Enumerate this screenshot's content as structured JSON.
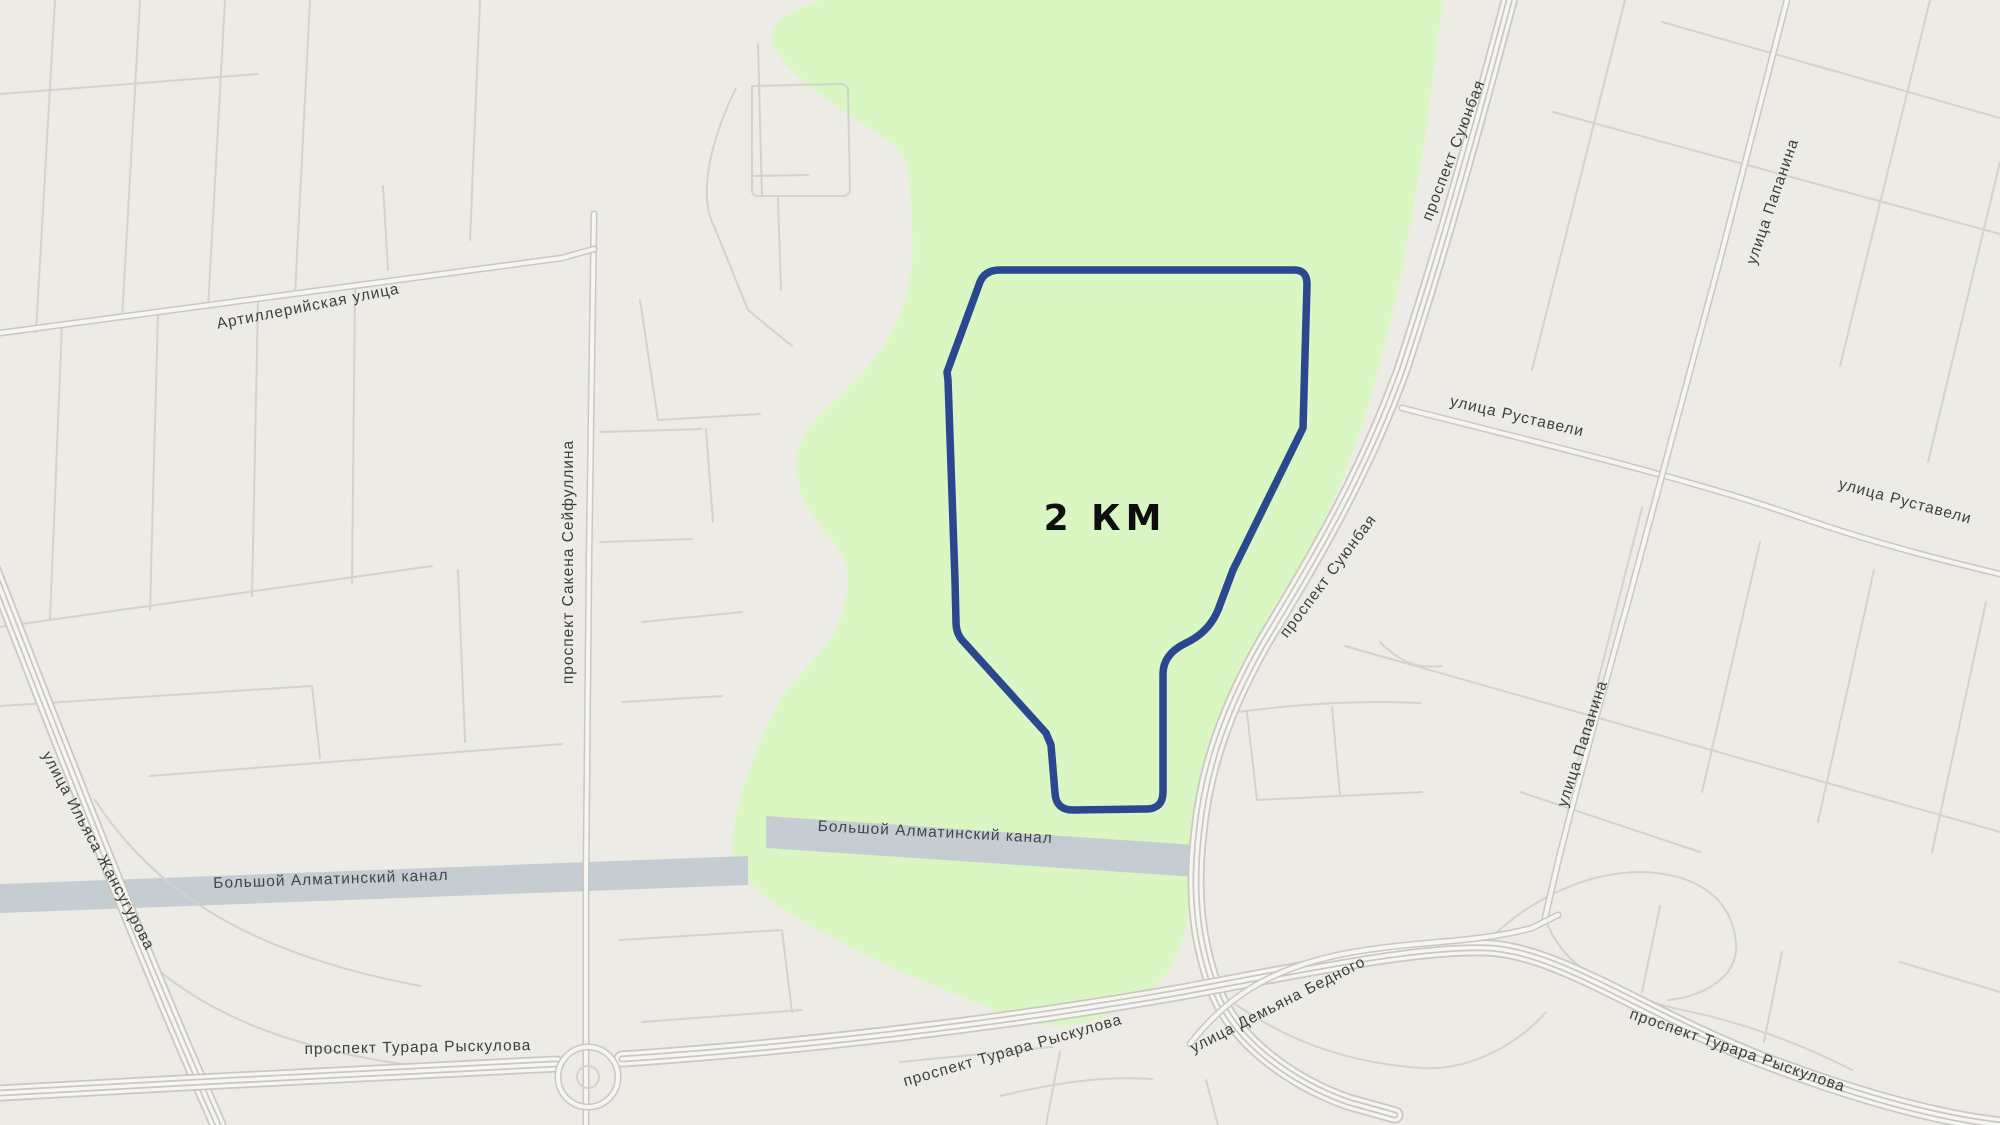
{
  "map": {
    "labels": {
      "artillery_street": "Артиллерийская улица",
      "seifullin_avenue": "проспект Сакена Сейфуллина",
      "zhansugurov_street": "улица Ильяса Жансугурова",
      "almaty_canal": "Большой Алматинский канал",
      "ryskulov_avenue": "проспект Турара Рыскулова",
      "suyunbay_avenue": "проспект Суюнбая",
      "rustaveli_street": "улица Руставели",
      "papanin_street": "улица Папанина",
      "demyan_bedny_street": "улица Демьяна Бедного",
      "route_distance": "2 КМ"
    },
    "colors": {
      "background": "#edebe5",
      "park": "#d9f6c3",
      "canal": "#c5cdd2",
      "route": "#2b4790",
      "road_casing": "#c9c8c3",
      "road_fill": "#f6f5f1",
      "minor_road": "#d3d2cd",
      "label_text": "#3e3e3c"
    }
  }
}
